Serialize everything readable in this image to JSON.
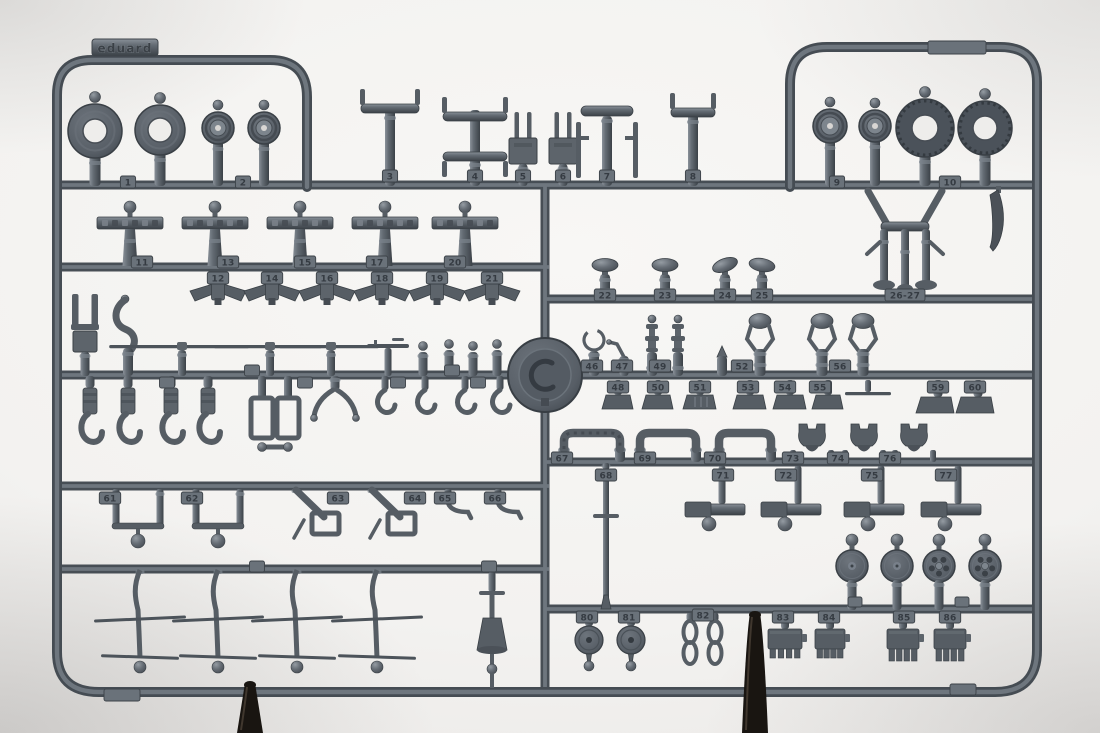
{
  "photo": {
    "brand_tab": {
      "text": "eduard"
    },
    "colors": {
      "background_center": "#f8f7f5",
      "background_edge": "#d0cecc",
      "plastic_base": "#5d646b",
      "plastic_mid": "#565d64",
      "plastic_dark": "#454b52",
      "plastic_light": "#7b838b",
      "plastic_line": "#3a4046",
      "tire_dark": "#4b525a",
      "tab_fill": "#6a727a",
      "number_color": "#353b42",
      "hole_bg": "#eeedeb",
      "stand": "#191511"
    }
  },
  "sprue": {
    "number_tabs": [
      {
        "n": "1",
        "x": 128,
        "y": 176
      },
      {
        "n": "2",
        "x": 243,
        "y": 176
      },
      {
        "n": "3",
        "x": 390,
        "y": 170
      },
      {
        "n": "4",
        "x": 475,
        "y": 170
      },
      {
        "n": "5",
        "x": 523,
        "y": 170
      },
      {
        "n": "6",
        "x": 563,
        "y": 170
      },
      {
        "n": "7",
        "x": 607,
        "y": 170
      },
      {
        "n": "8",
        "x": 693,
        "y": 170
      },
      {
        "n": "9",
        "x": 837,
        "y": 176
      },
      {
        "n": "10",
        "x": 950,
        "y": 176
      },
      {
        "n": "11",
        "x": 142,
        "y": 256
      },
      {
        "n": "13",
        "x": 228,
        "y": 256
      },
      {
        "n": "15",
        "x": 305,
        "y": 256
      },
      {
        "n": "17",
        "x": 377,
        "y": 256
      },
      {
        "n": "20",
        "x": 455,
        "y": 256
      },
      {
        "n": "12",
        "x": 218,
        "y": 272
      },
      {
        "n": "14",
        "x": 272,
        "y": 272
      },
      {
        "n": "16",
        "x": 327,
        "y": 272
      },
      {
        "n": "18",
        "x": 382,
        "y": 272
      },
      {
        "n": "19",
        "x": 437,
        "y": 272
      },
      {
        "n": "21",
        "x": 492,
        "y": 272
      },
      {
        "n": "22",
        "x": 605,
        "y": 289
      },
      {
        "n": "23",
        "x": 665,
        "y": 289
      },
      {
        "n": "24",
        "x": 725,
        "y": 289
      },
      {
        "n": "25",
        "x": 762,
        "y": 289
      },
      {
        "n": "26-27",
        "x": 905,
        "y": 289
      },
      {
        "n": "46",
        "x": 592,
        "y": 360
      },
      {
        "n": "47",
        "x": 622,
        "y": 360
      },
      {
        "n": "49",
        "x": 660,
        "y": 360
      },
      {
        "n": "52",
        "x": 742,
        "y": 360
      },
      {
        "n": "56",
        "x": 840,
        "y": 360
      },
      {
        "n": "48",
        "x": 618,
        "y": 381
      },
      {
        "n": "50",
        "x": 658,
        "y": 381
      },
      {
        "n": "51",
        "x": 700,
        "y": 381
      },
      {
        "n": "53",
        "x": 748,
        "y": 381
      },
      {
        "n": "54",
        "x": 785,
        "y": 381
      },
      {
        "n": "55",
        "x": 820,
        "y": 381
      },
      {
        "n": "59",
        "x": 938,
        "y": 381
      },
      {
        "n": "60",
        "x": 975,
        "y": 381
      },
      {
        "n": "61",
        "x": 110,
        "y": 492
      },
      {
        "n": "62",
        "x": 192,
        "y": 492
      },
      {
        "n": "63",
        "x": 338,
        "y": 492
      },
      {
        "n": "64",
        "x": 415,
        "y": 492
      },
      {
        "n": "65",
        "x": 445,
        "y": 492
      },
      {
        "n": "66",
        "x": 495,
        "y": 492
      },
      {
        "n": "67",
        "x": 562,
        "y": 452
      },
      {
        "n": "69",
        "x": 645,
        "y": 452
      },
      {
        "n": "70",
        "x": 715,
        "y": 452
      },
      {
        "n": "73",
        "x": 793,
        "y": 452
      },
      {
        "n": "74",
        "x": 838,
        "y": 452
      },
      {
        "n": "76",
        "x": 890,
        "y": 452
      },
      {
        "n": "68",
        "x": 606,
        "y": 469
      },
      {
        "n": "71",
        "x": 723,
        "y": 469
      },
      {
        "n": "72",
        "x": 786,
        "y": 469
      },
      {
        "n": "75",
        "x": 872,
        "y": 469
      },
      {
        "n": "77",
        "x": 946,
        "y": 469
      },
      {
        "n": "80",
        "x": 587,
        "y": 611
      },
      {
        "n": "81",
        "x": 629,
        "y": 611
      },
      {
        "n": "82",
        "x": 703,
        "y": 609
      },
      {
        "n": "83",
        "x": 783,
        "y": 611
      },
      {
        "n": "84",
        "x": 829,
        "y": 611
      },
      {
        "n": "85",
        "x": 904,
        "y": 611
      },
      {
        "n": "86",
        "x": 950,
        "y": 611
      }
    ],
    "blank_tabs": [
      {
        "x": 957,
        "y": 41,
        "w": 58,
        "h": 13
      },
      {
        "x": 122,
        "y": 689,
        "w": 36,
        "h": 12
      },
      {
        "x": 963,
        "y": 684,
        "w": 26,
        "h": 11
      },
      {
        "x": 167,
        "y": 377,
        "w": 15,
        "h": 11
      },
      {
        "x": 252,
        "y": 365,
        "w": 15,
        "h": 11
      },
      {
        "x": 305,
        "y": 377,
        "w": 15,
        "h": 11
      },
      {
        "x": 398,
        "y": 377,
        "w": 15,
        "h": 11
      },
      {
        "x": 452,
        "y": 365,
        "w": 15,
        "h": 11
      },
      {
        "x": 478,
        "y": 377,
        "w": 15,
        "h": 11
      },
      {
        "x": 257,
        "y": 561,
        "w": 15,
        "h": 11
      },
      {
        "x": 489,
        "y": 561,
        "w": 15,
        "h": 11
      },
      {
        "x": 855,
        "y": 597,
        "w": 14,
        "h": 10
      },
      {
        "x": 962,
        "y": 597,
        "w": 14,
        "h": 10
      }
    ],
    "parts": [
      {
        "t": "ring",
        "x": 95,
        "cy": 131,
        "r": 27,
        "hole": 12
      },
      {
        "t": "ring",
        "x": 160,
        "cy": 130,
        "r": 25,
        "hole": 12
      },
      {
        "t": "hubw",
        "x": 218,
        "cy": 128,
        "r": 16
      },
      {
        "t": "hubw",
        "x": 264,
        "cy": 128,
        "r": 16
      },
      {
        "t": "strutT",
        "x": 390,
        "top": 104,
        "w": 58
      },
      {
        "t": "strutH",
        "x": 475
      },
      {
        "t": "forkPlate",
        "x": 523
      },
      {
        "t": "forkPlate",
        "x": 563
      },
      {
        "t": "ibeam",
        "x": 607
      },
      {
        "t": "strutT",
        "x": 693,
        "top": 108,
        "w": 44
      },
      {
        "t": "hubw",
        "x": 830,
        "cy": 126,
        "r": 17
      },
      {
        "t": "hubw",
        "x": 875,
        "cy": 126,
        "r": 16
      },
      {
        "t": "tire",
        "x": 925,
        "cy": 128,
        "r": 29,
        "hole": 13
      },
      {
        "t": "tire",
        "x": 985,
        "cy": 128,
        "r": 27,
        "hole": 12
      },
      {
        "t": "engineMount",
        "x": 905
      },
      {
        "t": "knife",
        "x": 1000
      },
      {
        "t": "panel",
        "x": 130
      },
      {
        "t": "panel",
        "x": 215
      },
      {
        "t": "panel",
        "x": 300
      },
      {
        "t": "panel",
        "x": 385
      },
      {
        "t": "panel",
        "x": 465
      },
      {
        "t": "vpart",
        "x": 218
      },
      {
        "t": "vpart",
        "x": 272
      },
      {
        "t": "vpart",
        "x": 327
      },
      {
        "t": "vpart",
        "x": 382
      },
      {
        "t": "vpart",
        "x": 437
      },
      {
        "t": "vpart",
        "x": 492
      },
      {
        "t": "forkTall",
        "x": 85
      },
      {
        "t": "hookCurve",
        "x": 128
      },
      {
        "t": "blade",
        "x": 182,
        "len": 140
      },
      {
        "t": "blade",
        "x": 270,
        "len": 108
      },
      {
        "t": "blade",
        "x": 331,
        "len": 100
      },
      {
        "t": "gun",
        "x": 388
      },
      {
        "t": "cyl",
        "x": 423,
        "h": 24
      },
      {
        "t": "cyl",
        "x": 449,
        "h": 26
      },
      {
        "t": "cyl",
        "x": 473,
        "h": 24
      },
      {
        "t": "cyl",
        "x": 497,
        "h": 26
      },
      {
        "t": "clamp",
        "x": 90
      },
      {
        "t": "clamp",
        "x": 128
      },
      {
        "t": "clamp",
        "x": 171
      },
      {
        "t": "clamp",
        "x": 208
      },
      {
        "t": "rectFrame",
        "x": 262
      },
      {
        "t": "rectFrame",
        "x": 288
      },
      {
        "t": "dumbbell",
        "x1": 262,
        "x2": 288,
        "y": 447
      },
      {
        "t": "vspread",
        "x": 335
      },
      {
        "t": "hookSm",
        "x": 385
      },
      {
        "t": "hookSm",
        "x": 425
      },
      {
        "t": "hookSm",
        "x": 465
      },
      {
        "t": "hookSm",
        "x": 500
      },
      {
        "t": "knob",
        "x": 605
      },
      {
        "t": "knob",
        "x": 665
      },
      {
        "t": "knob",
        "x": 725,
        "tilt": -20
      },
      {
        "t": "knob",
        "x": 762,
        "tilt": 10
      },
      {
        "t": "ringLoop",
        "x": 594
      },
      {
        "t": "lever",
        "x": 624
      },
      {
        "t": "candle",
        "x": 652
      },
      {
        "t": "candle",
        "x": 678
      },
      {
        "t": "bullet",
        "x": 722
      },
      {
        "t": "forkCap",
        "x": 760
      },
      {
        "t": "forkCap",
        "x": 822
      },
      {
        "t": "forkCap",
        "x": 863
      },
      {
        "t": "wedge",
        "x": 618,
        "w": 24
      },
      {
        "t": "wedge",
        "x": 658,
        "w": 24
      },
      {
        "t": "wedge",
        "x": 700,
        "w": 26,
        "striped": true
      },
      {
        "t": "wedge",
        "x": 750,
        "w": 26
      },
      {
        "t": "wedge",
        "x": 790,
        "w": 26
      },
      {
        "t": "wedge",
        "x": 828,
        "w": 24
      },
      {
        "t": "thinLine",
        "x": 868
      },
      {
        "t": "wedgeBig",
        "x": 938
      },
      {
        "t": "wedgeBig",
        "x": 978
      },
      {
        "t": "hframe",
        "x": 138
      },
      {
        "t": "hframe",
        "x": 218
      },
      {
        "t": "diagArm",
        "x": 296
      },
      {
        "t": "diagArm",
        "x": 372
      },
      {
        "t": "lhook",
        "x": 448
      },
      {
        "t": "lhook",
        "x": 498
      },
      {
        "t": "arch",
        "x": 592,
        "w": 56,
        "tex": true
      },
      {
        "t": "arch",
        "x": 668,
        "w": 56
      },
      {
        "t": "arch",
        "x": 745,
        "w": 52
      },
      {
        "t": "bullhead",
        "x": 812
      },
      {
        "t": "bullhead",
        "x": 864
      },
      {
        "t": "bullhead",
        "x": 914
      },
      {
        "t": "rodLong",
        "x": 606
      },
      {
        "t": "strip",
        "x": 716
      },
      {
        "t": "strip",
        "x": 792
      },
      {
        "t": "strip",
        "x": 875
      },
      {
        "t": "strip",
        "x": 952
      },
      {
        "t": "disc",
        "x": 852
      },
      {
        "t": "disc",
        "x": 897
      },
      {
        "t": "disc",
        "x": 939,
        "spoked": true
      },
      {
        "t": "disc",
        "x": 985,
        "spoked": true
      },
      {
        "t": "discHole",
        "x": 589
      },
      {
        "t": "discHole",
        "x": 631
      },
      {
        "t": "chain",
        "x": 690
      },
      {
        "t": "chain",
        "x": 715
      },
      {
        "t": "comb",
        "x": 785,
        "w": 34
      },
      {
        "t": "comb",
        "x": 830,
        "w": 30
      },
      {
        "t": "comb",
        "x": 903,
        "w": 32,
        "tall": true
      },
      {
        "t": "comb",
        "x": 950,
        "w": 32,
        "tall": true
      },
      {
        "t": "mast",
        "x": 140
      },
      {
        "t": "mast",
        "x": 218
      },
      {
        "t": "mast",
        "x": 297
      },
      {
        "t": "mast",
        "x": 377
      },
      {
        "t": "funnel",
        "x": 492
      }
    ],
    "stands": [
      {
        "x": 250,
        "tip": 683
      },
      {
        "x": 755,
        "tip": 613
      }
    ]
  }
}
